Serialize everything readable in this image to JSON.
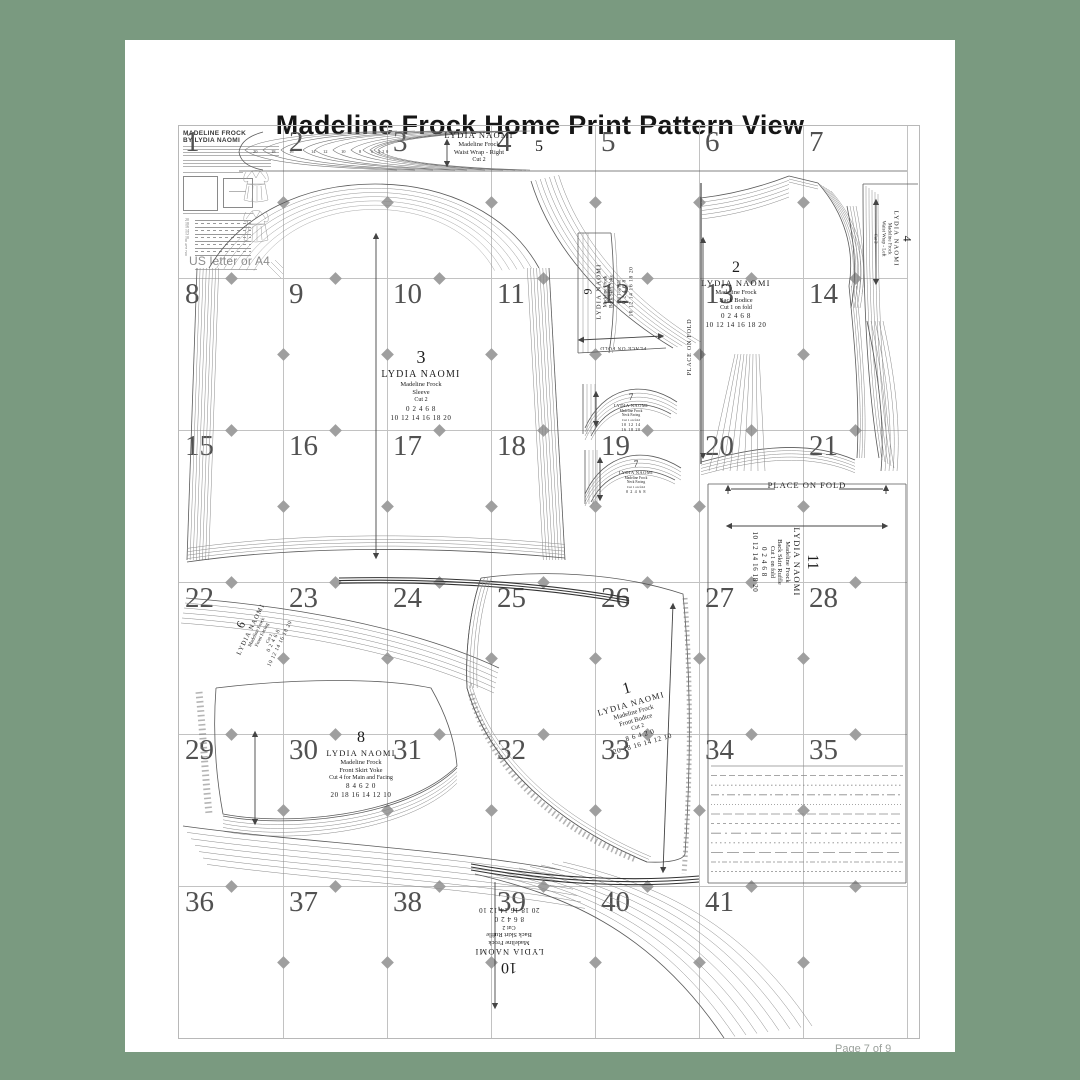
{
  "page": {
    "title": "Madeline Frock Home Print Pattern View",
    "footer": "Page 7 of 9"
  },
  "info_panel": {
    "heading1": "MADELINE FROCK",
    "heading2": "BY LYDIA NAOMI",
    "paper": "US letter or A4",
    "size_key": [
      "20",
      "18",
      "16",
      "14",
      "12",
      "10",
      "8",
      "6",
      "4",
      "2",
      "0"
    ]
  },
  "sheet": {
    "grid_numbers": [
      "1",
      "2",
      "3",
      "4",
      "5",
      "6",
      "7",
      "8",
      "9",
      "10",
      "11",
      "12",
      "13",
      "14",
      "15",
      "16",
      "17",
      "18",
      "19",
      "20",
      "21",
      "22",
      "23",
      "24",
      "25",
      "26",
      "27",
      "28",
      "29",
      "30",
      "31",
      "32",
      "33",
      "34",
      "35",
      "36",
      "37",
      "38",
      "39",
      "40",
      "41"
    ],
    "fold_label": "PLACE ON FOLD",
    "size_run": [
      "20",
      "18",
      "16",
      "14",
      "12",
      "10",
      "8",
      "6",
      "4",
      "2",
      "0"
    ],
    "pieces": {
      "p5": {
        "number": "5",
        "brand": "LYDIA NAOMI",
        "pattern": "Madeline Frock",
        "name": "Waist Wrap - Right",
        "cut": "Cut 2"
      },
      "p3": {
        "number": "3",
        "brand": "LYDIA NAOMI",
        "pattern": "Madeline Frock",
        "name": "Sleeve",
        "cut": "Cut 2",
        "sizes1": "0 2 4 6 8",
        "sizes2": "10 12 14 16 18 20"
      },
      "p9": {
        "number": "9",
        "brand": "LYDIA NAOMI",
        "pattern": "Madeline Frock",
        "name": "Back Skirt Yoke",
        "cut": "Cut 1 on fold",
        "sizes1": "0 2 4 6 8",
        "sizes2": "10 12 14 16 18 20"
      },
      "p2": {
        "number": "2",
        "brand": "LYDIA NAOMI",
        "pattern": "Madeline Frock",
        "name": "Back Bodice",
        "cut": "Cut 1 on fold",
        "sizes1": "0 2 4 6 8",
        "sizes2": "10 12 14 16 18 20"
      },
      "p4": {
        "number": "4",
        "brand": "LYDIA NAOMI",
        "pattern": "Madeline Frock",
        "name": "Waist Wrap - Left",
        "cut": "Cut 2"
      },
      "p7a": {
        "number": "7",
        "brand": "LYDIA NAOMI",
        "pattern": "Madeline Frock",
        "name": "Neck Facing",
        "cut": "Cut 1 on fold",
        "sizes1": "10 12 14",
        "sizes2": "16 18 20"
      },
      "p7b": {
        "number": "7",
        "brand": "LYDIA NAOMI",
        "pattern": "Madeline Frock",
        "name": "Neck Facing",
        "cut": "Cut 1 on fold",
        "sizes1": "0 2 4 6 8"
      },
      "p11": {
        "number": "11",
        "brand": "LYDIA NAOMI",
        "pattern": "Madeline Frock",
        "name": "Back Skirt Ruffle",
        "cut": "Cut 1 on fold",
        "sizes1": "0 2 4 6 8",
        "sizes2": "10 12 14 16 18 20"
      },
      "p6": {
        "number": "6",
        "brand": "LYDIA NAOMI",
        "pattern": "Madeline Frock",
        "name": "Front Facing",
        "cut": "Cut 2",
        "sizes1": "0 2 4 6 8",
        "sizes2": "10 12 14 16 18 20"
      },
      "p8": {
        "number": "8",
        "brand": "LYDIA NAOMI",
        "pattern": "Madeline Frock",
        "name": "Front Skirt Yoke",
        "cut": "Cut 4 for Main and Facing",
        "sizes1": "8 4 6 2 0",
        "sizes2": "20 18 16 14 12 10"
      },
      "p1": {
        "number": "1",
        "brand": "LYDIA NAOMI",
        "pattern": "Madeline Frock",
        "name": "Front Bodice",
        "cut": "Cut 2",
        "sizes1": "8 6 4 2 0",
        "sizes2": "20 18 16 14 12 10"
      },
      "p10": {
        "number": "10",
        "brand": "LYDIA NAOMI",
        "pattern": "Madeline Frock",
        "name": "Back Skirt Ruffle",
        "cut": "Cut 2",
        "sizes1": "8 6 4 2 0",
        "sizes2": "20 18 16 14 12 10"
      }
    }
  },
  "colors": {
    "background": "#7a9a80",
    "card": "#ffffff",
    "grid_line": "#c2c2c2",
    "grid_number": "#515151",
    "pattern_ink": "#555555"
  }
}
